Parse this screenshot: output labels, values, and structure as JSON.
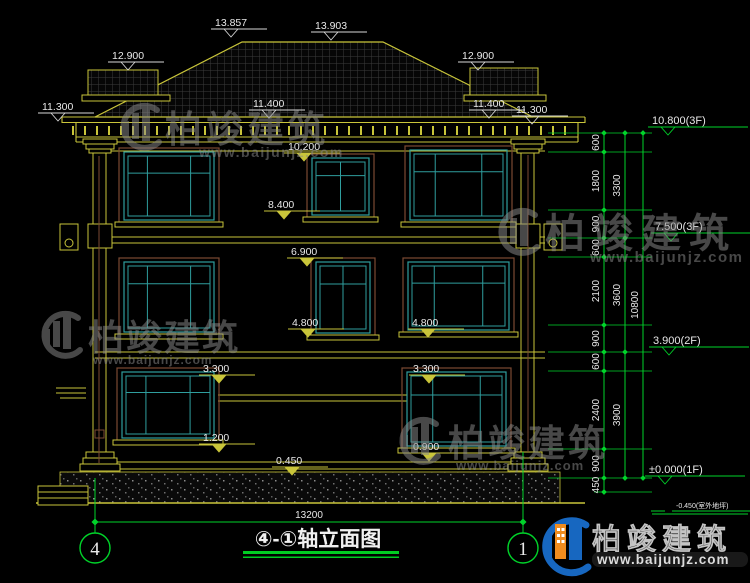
{
  "meta": {
    "title_text": "④-①轴立面图"
  },
  "marks_top": [
    "13.857",
    "13.903",
    "12.900",
    "12.900",
    "11.300",
    "11.400",
    "11.400",
    "11.300"
  ],
  "marks_facade": [
    "10.200",
    "8.400",
    "6.900",
    "4.800",
    "4.800",
    "3.300",
    "3.300",
    "1.200",
    "0.900",
    "0.450"
  ],
  "levels_right": [
    "10.800(3F)",
    "7.500(3F)",
    "3.900(2F)",
    "±0.000(1F)",
    "-0.450(室外地坪)"
  ],
  "dims": {
    "chain_inner": [
      "600",
      "1800",
      "900",
      "600",
      "2100",
      "900",
      "600",
      "2400",
      "900",
      "450"
    ],
    "chain_floors": [
      "3300",
      "3600",
      "3900"
    ],
    "chain_total": "10800",
    "bottom_total": "13200"
  },
  "grid_bubbles": [
    "4",
    "1"
  ],
  "watermark": {
    "brand": "柏竣建筑",
    "url": "www.baijunjz.com"
  },
  "logo": {
    "brand": "柏竣建筑",
    "url": "www.baijunjz.com"
  },
  "colors": {
    "line_yellow": "#c9c53a",
    "dim_green": "#00d42a",
    "window_teal": "#2f9e9e",
    "frame_brown": "#7c4a33",
    "text_white": "#e8e8e8",
    "logo_blue": "#1767c0",
    "logo_orange": "#f08c1e"
  }
}
